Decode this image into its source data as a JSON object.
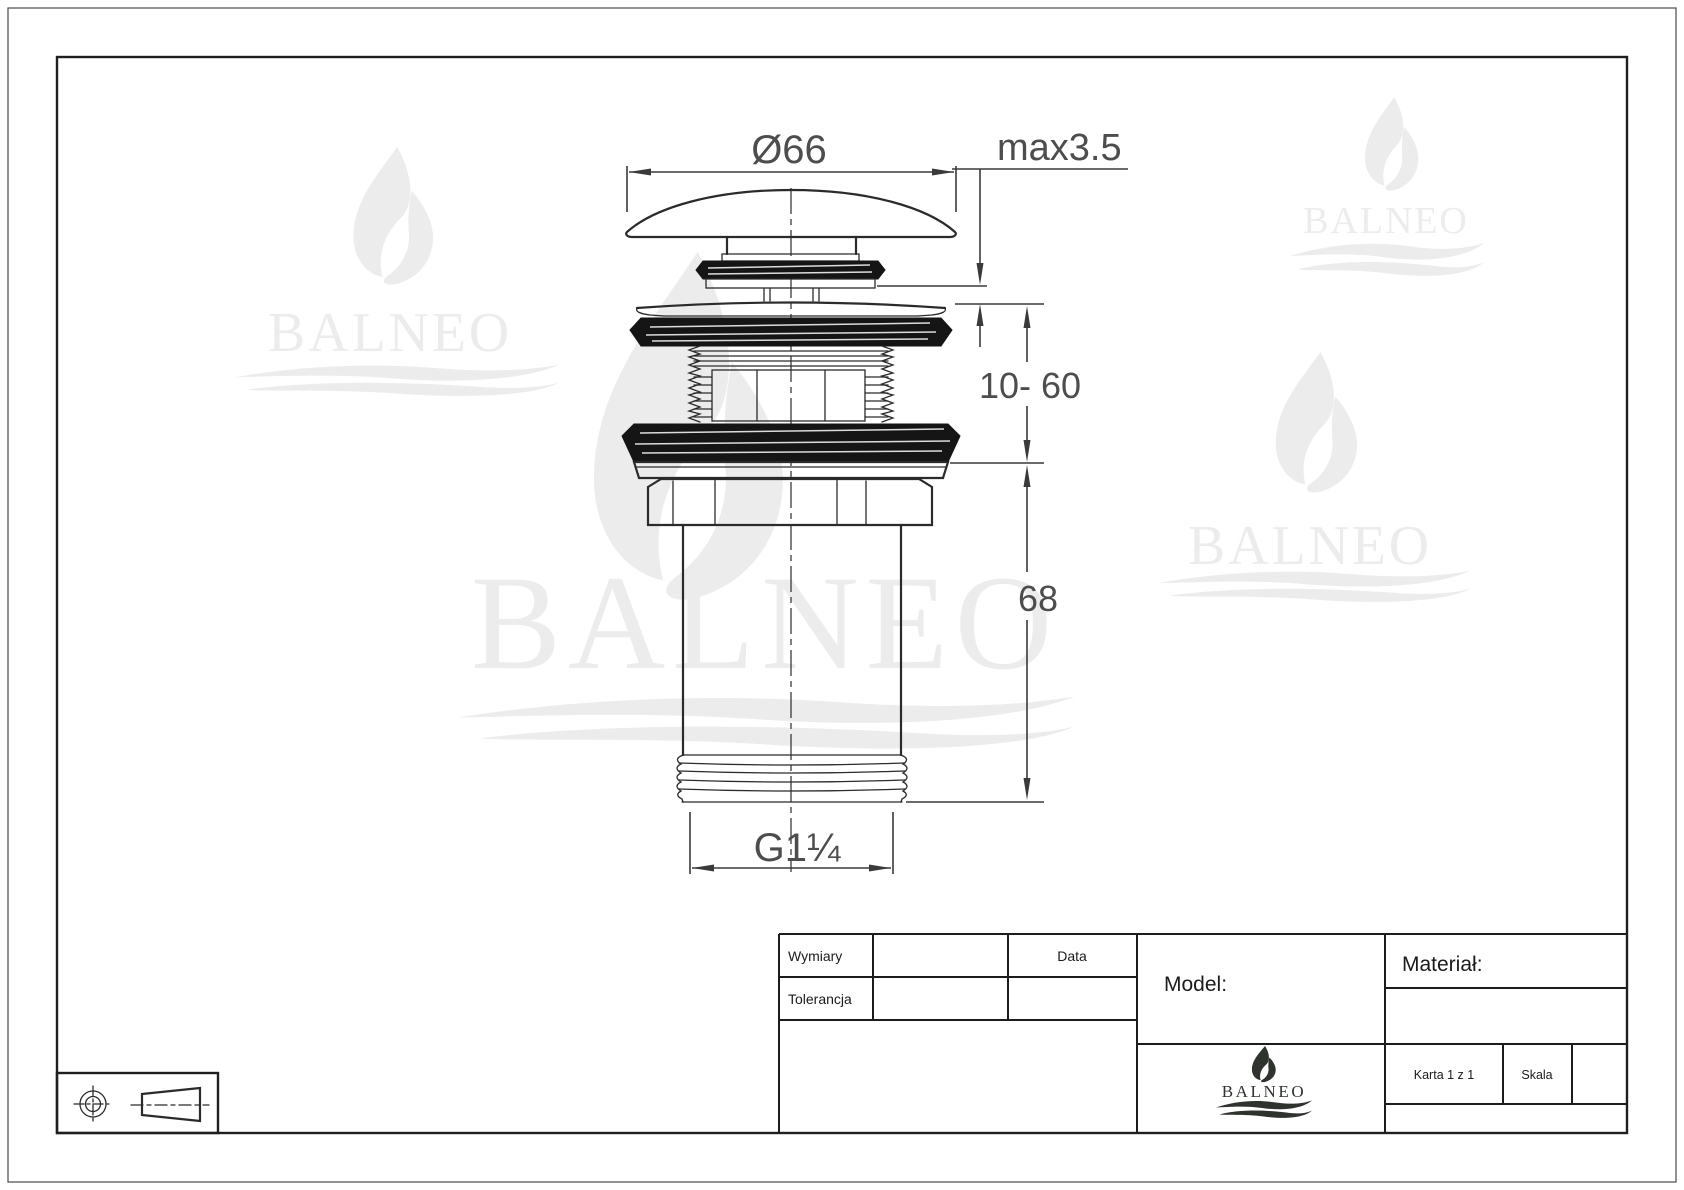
{
  "brand": {
    "name": "BALNEO"
  },
  "dimensions": {
    "diameter": "Ø66",
    "cap_clearance": "max3.5",
    "clamping_range": "10- 60",
    "body_length": "68",
    "outlet_thread": "G1¼"
  },
  "title_block": {
    "labels": {
      "dimensions": "Wymiary",
      "tolerance": "Tolerancja",
      "date": "Data",
      "model": "Model:",
      "material": "Materiał:",
      "sheet": "Karta 1 z 1",
      "scale": "Skala"
    }
  },
  "colors": {
    "drawing_line": "#2b2b2b",
    "dimension_text": "#4d4d4d",
    "watermark": "#ececec",
    "logo": "#2e332e",
    "background": "#ffffff"
  }
}
